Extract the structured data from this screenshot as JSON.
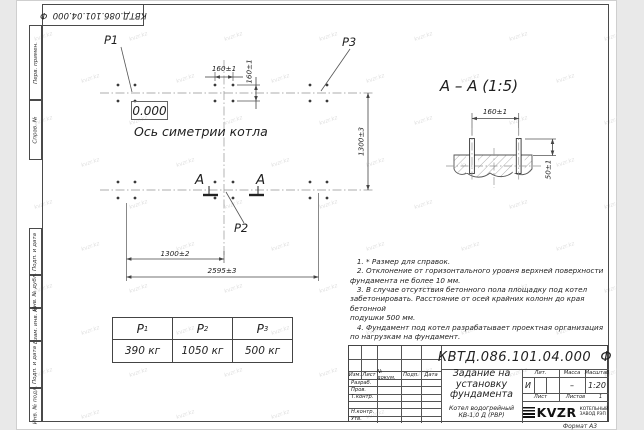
{
  "sheet": {
    "corner_stamp": "КВТД.086.101.04.000  Ф",
    "margin_labels": [
      "Перв. примен.",
      "Справ. №",
      "Подп. и дата",
      "Инв. № дубл.",
      "Взам. инв. №",
      "Подп. и дата",
      "Инв. № подл."
    ],
    "format_note": "Формат А3",
    "watermark": "kvzr.kz"
  },
  "plan": {
    "labels": {
      "p1": "P1",
      "p2": "P2",
      "p3": "P3"
    },
    "elevation": "0.000",
    "axis_caption": "Ось симетрии котла",
    "section_mark": "А",
    "dims": {
      "pitch_x": "160±1",
      "pitch_y": "160±1",
      "rows_span": "1300±3",
      "half_span": "1300±2",
      "total_span": "2595±3"
    }
  },
  "section_view": {
    "title": "А – А (1:5)",
    "dims": {
      "bolt_pitch": "160±1",
      "protrusion": "50±1"
    }
  },
  "loads_table": {
    "columns": [
      {
        "name": "P",
        "sub": "1",
        "value": "390 кг"
      },
      {
        "name": "P",
        "sub": "2",
        "value": "1050 кг"
      },
      {
        "name": "P",
        "sub": "3",
        "value": "500 кг"
      }
    ]
  },
  "notes": {
    "text": "   1. * Размер для справок.\n   2. Отклонение от горизонтального уровня верхней поверхности\nфундамента не более 10 мм.\n   3. В случае отсутствия бетонного пола площадку под котел\nзабетонировать. Расстояние от осей крайних колонн до края бетонной\nподушки 500 мм.\n   4. Фундамент под котел разрабатывает проектная организация\nпо нагрузкам на фундамент."
  },
  "title_block": {
    "doc_number": "КВТД.086.101.04.000  Ф",
    "title": "Задание на\nустановку\nфундамента",
    "product": "Котел водогрейный\nКВ-1,0 Д (РВР)",
    "header": {
      "izm": "Изм.",
      "list": "Лист",
      "doc": "№ докум.",
      "sign": "Подп.",
      "date": "Дата"
    },
    "rows": [
      "Разраб.",
      "Пров.",
      "Т.контр.",
      "",
      "Н.контр.",
      "Утв."
    ],
    "lit": {
      "label": "Лит.",
      "value": "И"
    },
    "mass": {
      "label": "Масса",
      "value": "–"
    },
    "scale": {
      "label": "Масштаб",
      "value": "1:20"
    },
    "sheet_cell": {
      "label": "Лист",
      "value": ""
    },
    "sheets_cell": {
      "label": "Листов",
      "value": "1"
    },
    "company": {
      "logo": "KVZR",
      "name": "КОТЕЛЬНЫЙ\nЗАВОД РЭП"
    }
  }
}
